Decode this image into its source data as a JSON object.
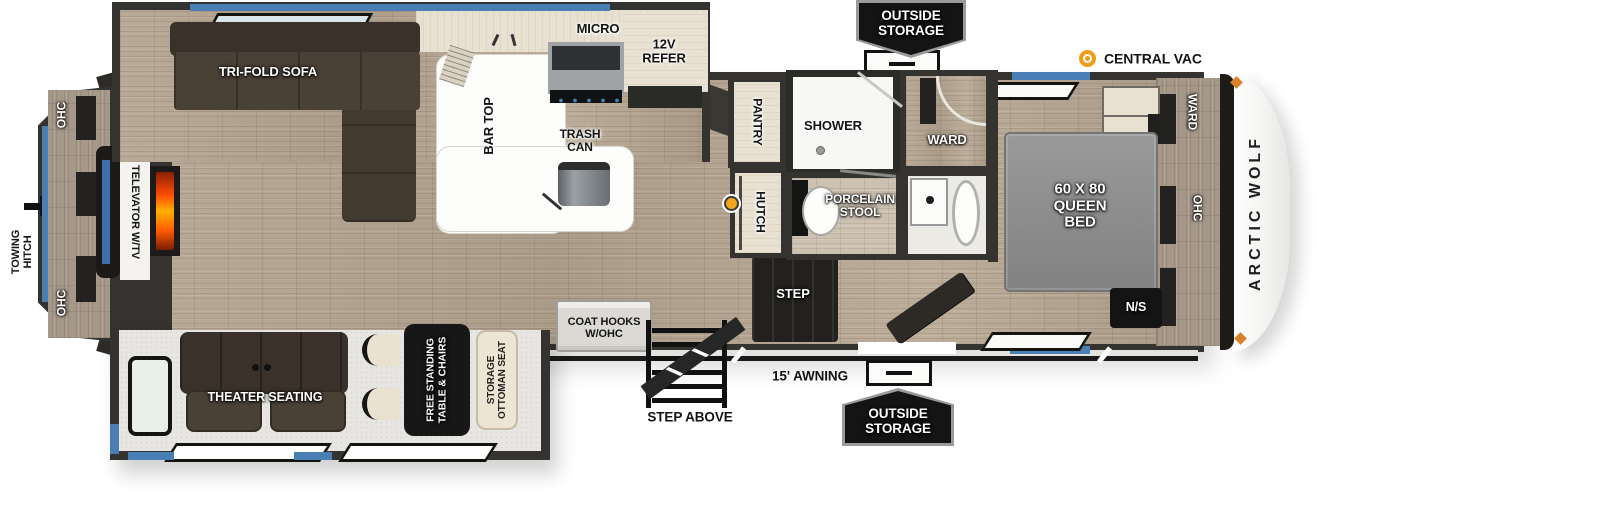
{
  "brand": "ARCTIC WOLF",
  "colors": {
    "accent_blue": "#4a7fb5",
    "wall_dark": "#35332f",
    "floor_wood": "#b3a492",
    "sofa_espresso": "#453c31",
    "badge_black": "#141414",
    "vac_orange": "#ef9e18",
    "fireplace_orange": "#ff5a00",
    "bed_gray": "#8f8f8f"
  },
  "rear": {
    "towing_hitch": "TOWING\nHITCH",
    "ohc_top": "OHC",
    "ohc_bottom": "OHC",
    "televator": "TELEVATOR W/TV"
  },
  "living": {
    "sofa": "TRI-FOLD SOFA",
    "theater_seating": "THEATER SEATING",
    "table": "FREE STANDING\nTABLE & CHAIRS",
    "ottoman": "STORAGE\nOTTOMAN SEAT",
    "coat_hooks": "COAT HOOKS\nW/OHC"
  },
  "kitchen": {
    "micro": "MICRO",
    "refer": "12V\nREFER",
    "bar_top": "BAR TOP",
    "trash_can": "TRASH\nCAN",
    "pantry": "PANTRY",
    "hutch": "HUTCH"
  },
  "bath": {
    "shower": "SHOWER",
    "stool": "PORCELAIN\nSTOOL",
    "ward": "WARD"
  },
  "bedroom": {
    "bed": "60 X 80\nQUEEN\nBED",
    "ward_side": "WARD",
    "ohc_side": "OHC",
    "nightstand": "N/S"
  },
  "exterior": {
    "outside_storage_top": "OUTSIDE\nSTORAGE",
    "outside_storage_bottom": "OUTSIDE\nSTORAGE",
    "central_vac": "CENTRAL VAC",
    "awning": "15' AWNING",
    "step": "STEP",
    "step_above": "STEP ABOVE"
  }
}
